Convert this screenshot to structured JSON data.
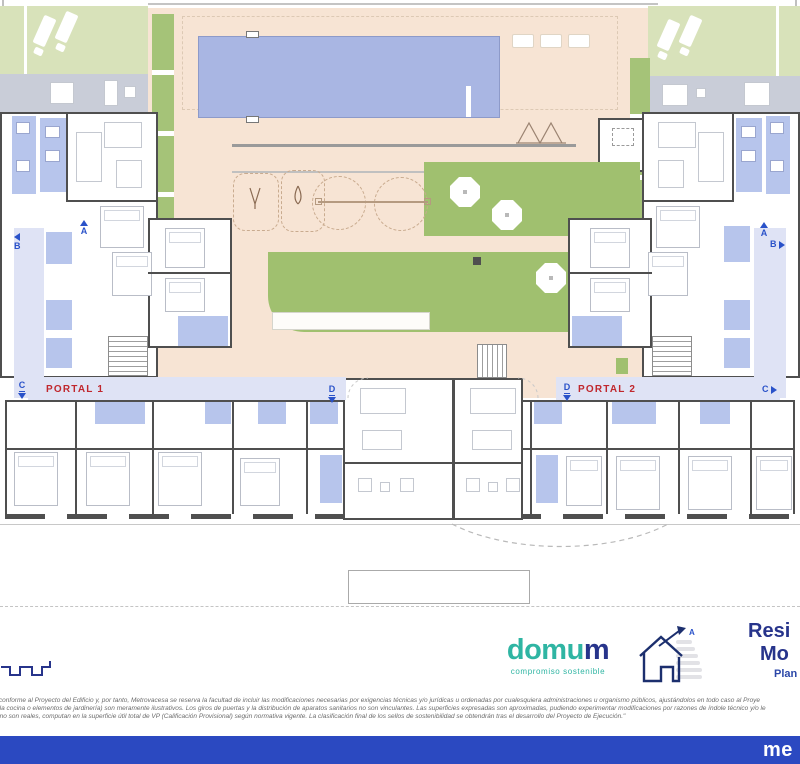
{
  "plan": {
    "portal1_label": "PORTAL 1",
    "portal2_label": "PORTAL 2",
    "section_markers": {
      "a": "A",
      "b": "B",
      "c": "C",
      "d": "D"
    }
  },
  "footer": {
    "domum_logo": {
      "text_main": "domu",
      "text_accent": "m",
      "tagline": "compromiso sostenible"
    },
    "energy_rating_label": "A",
    "project_title": {
      "line1": "Resi",
      "line2": "Mo",
      "line3": "Plan"
    },
    "disclaimer_lines": [
      "a ha sido elaborado conforme al Proyecto del Edificio y, por tanto, Metrovacesa se reserva la facultad de incluir las modificaciones necesarias por exigencias técnicas y/o jurídicas u ordenadas por cualesquiera administraciones u organismo públicos, ajustándolos en todo caso al Proye",
      "cluido en la zona de la cocina o elementos de jardinería) son meramente ilustrativos. Los giros de puertas y la distribución de aparatos sanitarios no son vinculantes. Las superficies expresadas son aproximadas, pudiendo experimentar modificaciones por razones de índole técnico y/o le",
      "zas reflejadas en plano son reales, computan en la superficie útil total de VP (Calificación Provisional) según normativa vigente. La clasificación final de los sellos de sostenibilidad se obtendrán tras el desarrollo del Proyecto de Ejecución.\""
    ]
  },
  "brand_bar": {
    "brand_text": "me"
  },
  "colors": {
    "metrovacesa_blue": "#2b49c1",
    "domum_teal": "#2fb5a3",
    "navy": "#27348b",
    "portal_red": "#c0272d",
    "marker_blue": "#2a52c9",
    "pool_blue": "#a9b6e3",
    "green": "#a0c06f",
    "courtyard_beige": "#f7e4d4",
    "room_blue": "#b7c5ec",
    "wall_gray": "#4f4f4f"
  }
}
